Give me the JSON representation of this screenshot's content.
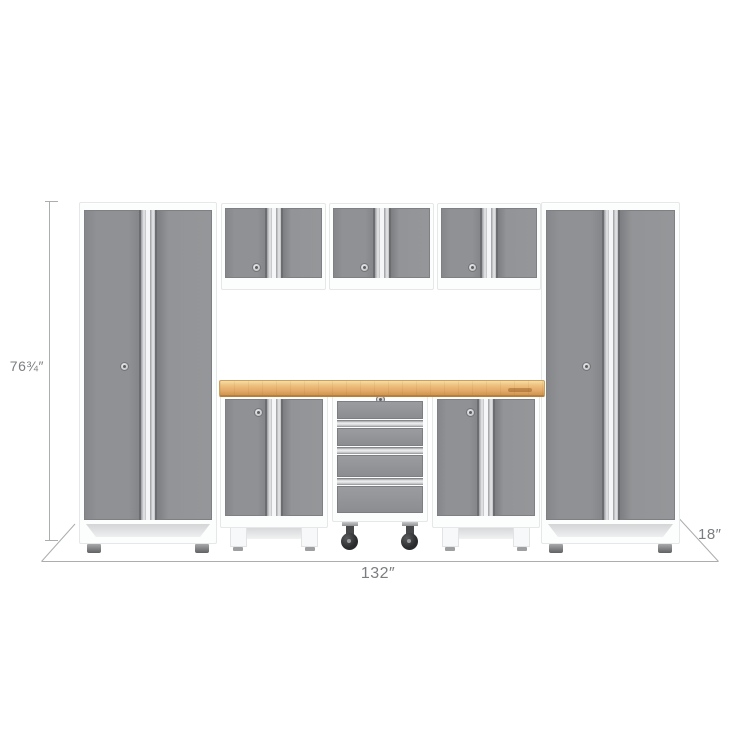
{
  "dimensions": {
    "height_label": "76¾″",
    "width_label": "132″",
    "depth_label": "18″"
  },
  "colors": {
    "door_gray": "#8f9194",
    "frame_white": "#fcfdfd",
    "chrome": "#e9eaec",
    "wood": "#e2a968",
    "caster_black": "#2a2b2d",
    "dim_line": "#abadaf",
    "dim_text": "#7b7e81",
    "shadow_gray": "#d4d5d7"
  }
}
